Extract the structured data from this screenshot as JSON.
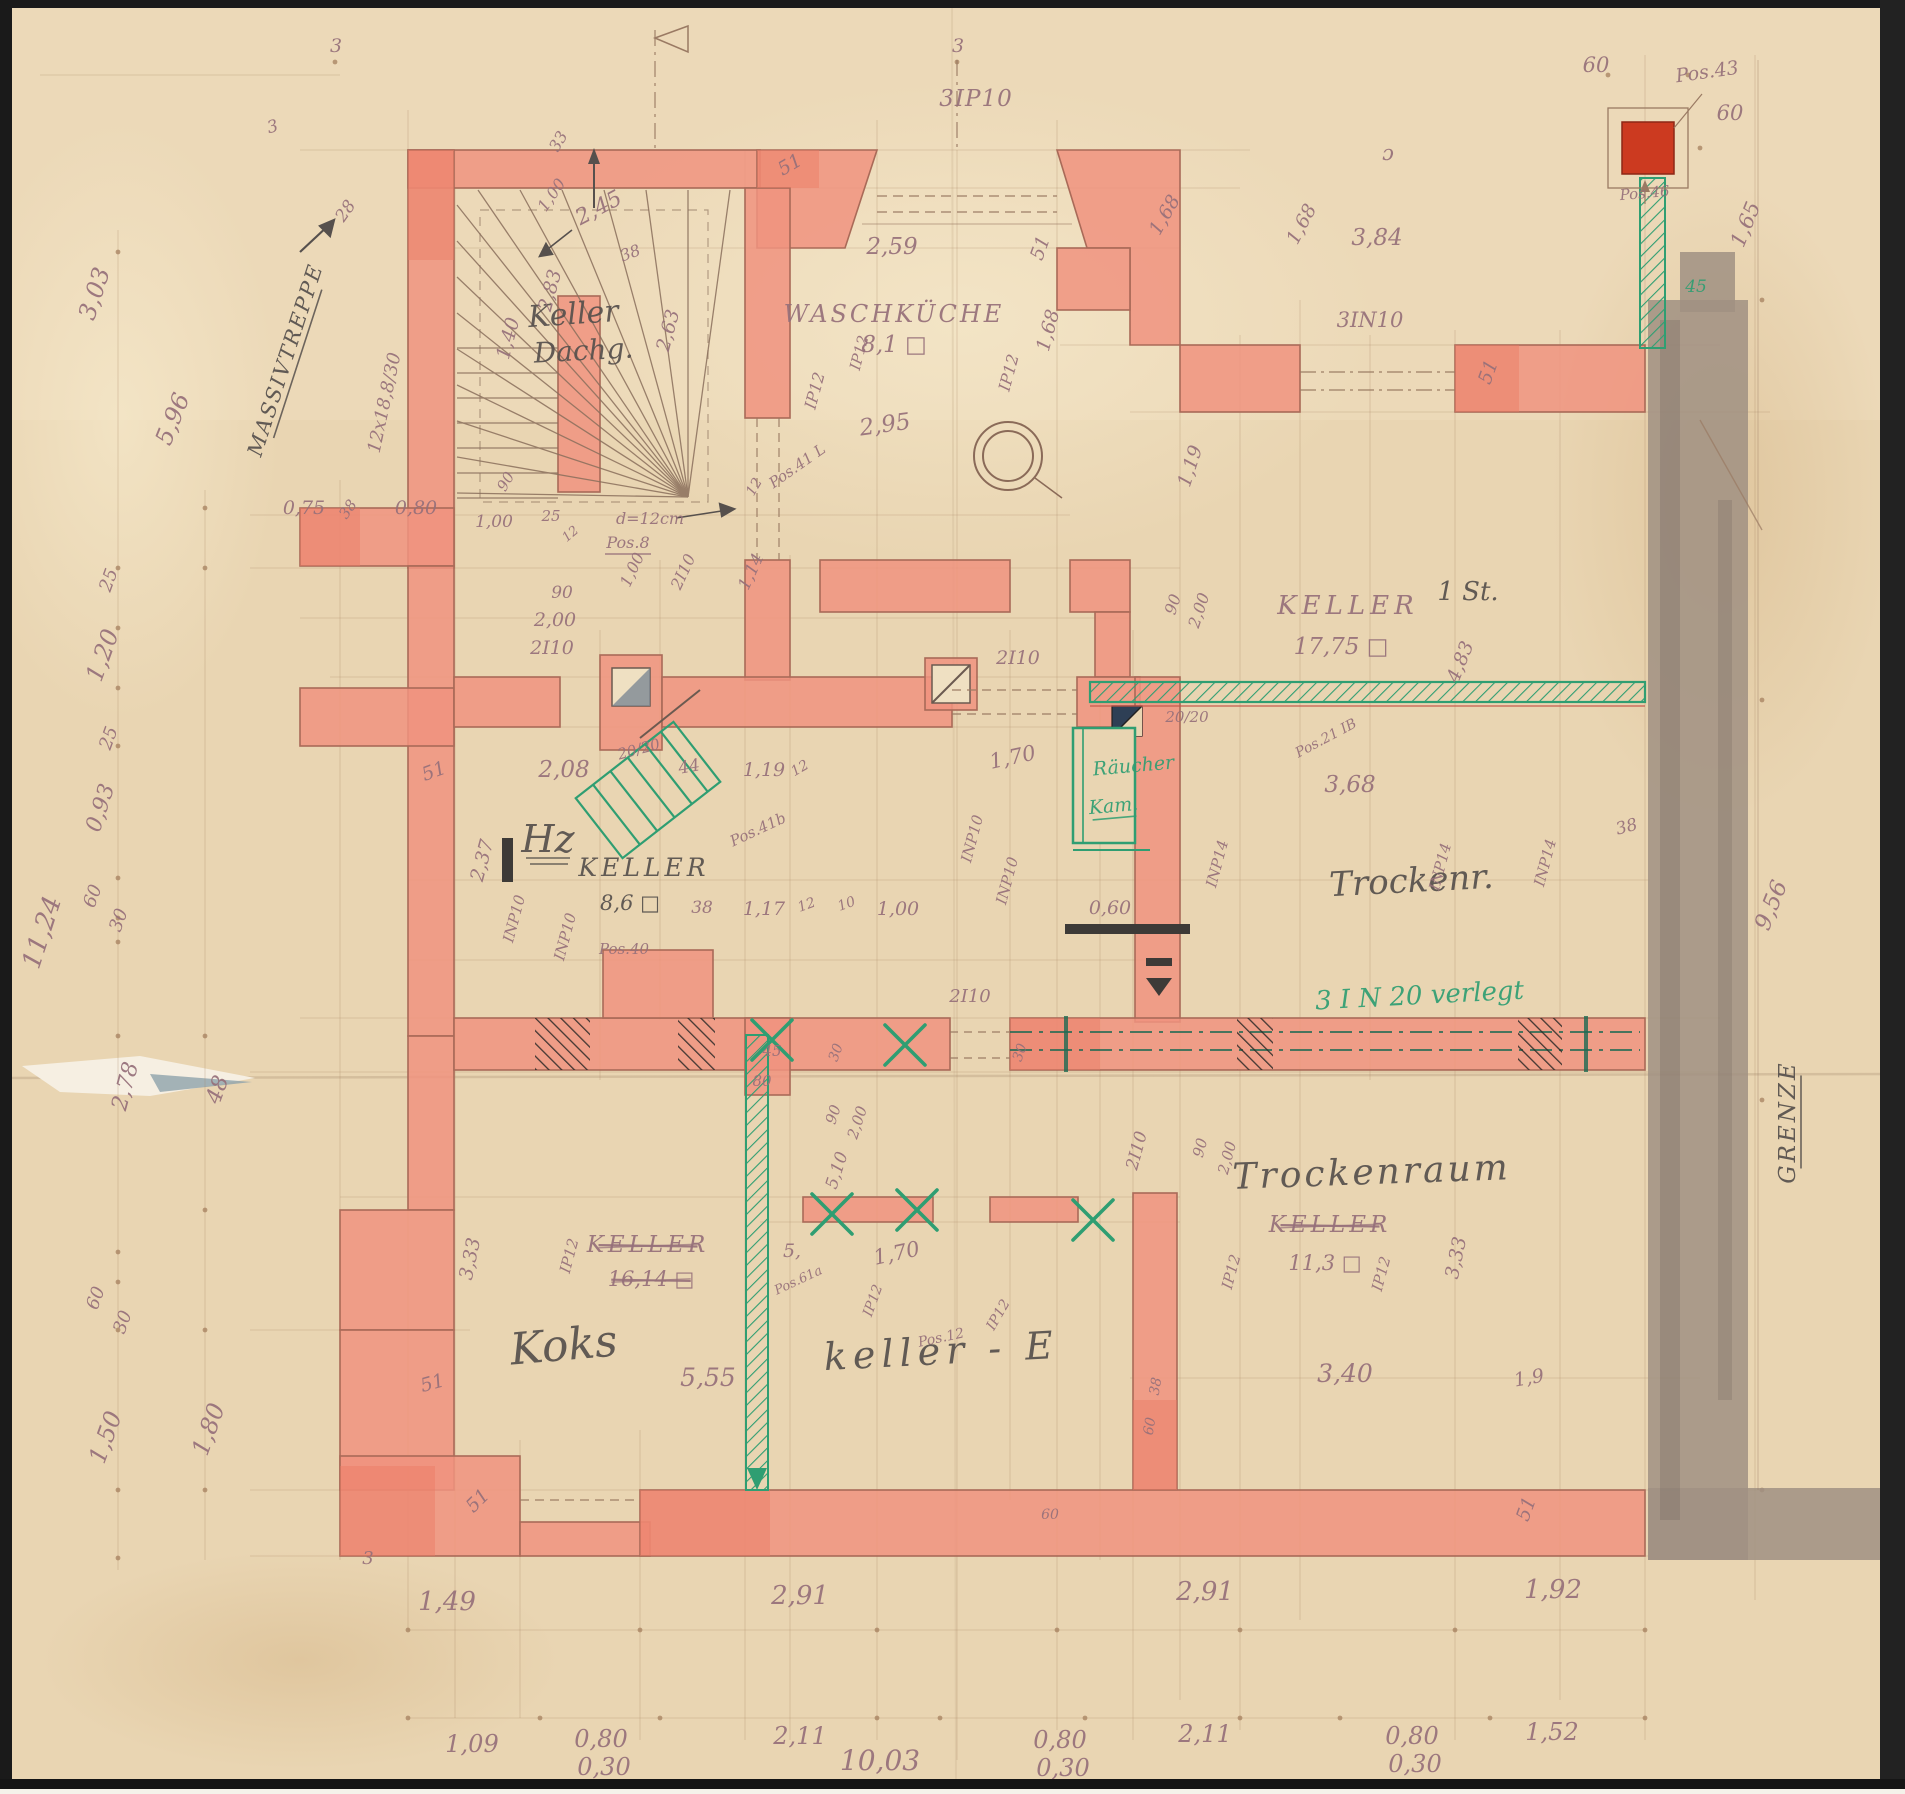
{
  "drawing": {
    "kind": "hand-drawn basement floor plan (scanned blueprint)",
    "language": "German",
    "boundary_label": "GRENZE",
    "stair_label": "MASSIVTREPPE",
    "stair_note": "12x18,8/30",
    "total_width_label": "10,03",
    "left_total_label": "11,24"
  },
  "colors": {
    "paper": "#e9d5b2",
    "paperLight": "#f2e4c6",
    "wall": "#f0937f",
    "wallDark": "#e9english7a64",
    "wallAccent": "#ea7a64",
    "wallLine": "#a96a58",
    "pencil": "#a5805f",
    "dim": "#96707a",
    "ink": "#56504d",
    "green": "#2f9e72",
    "graywall": "#a09183",
    "redsquare": "#cc3a20",
    "border": "#1a1a1a"
  },
  "rooms": [
    {
      "label": "Keller Dachg."
    },
    {
      "label": "Waschküche",
      "area": "8,1"
    },
    {
      "label": "Keller",
      "area": "17,75",
      "note": "1 St."
    },
    {
      "label": "Hz Keller",
      "area": "8,6"
    },
    {
      "label": "Trockenr."
    },
    {
      "label": "Räucher Kam.",
      "color": "green"
    },
    {
      "label": "Koks"
    },
    {
      "label": "Keller",
      "area": "16,14",
      "struck": true
    },
    {
      "label": "keller - E"
    },
    {
      "label": "Trockenraum",
      "former_label": "Keller",
      "former_struck": true,
      "area": "11,3"
    }
  ],
  "green_annotations": [
    "3 I N 20 verlegt",
    "Räucher Kam.",
    "45"
  ],
  "labels": [
    {
      "t": "3",
      "x": 336,
      "y": 52,
      "s": 19
    },
    {
      "t": "3",
      "x": 274,
      "y": 132,
      "s": 17,
      "r": -15
    },
    {
      "t": "MASSIVTREPPE",
      "x": 292,
      "y": 362,
      "r": -72,
      "s": 21,
      "c": "ink",
      "u": 1,
      "ls": 2
    },
    {
      "t": "28",
      "x": 350,
      "y": 214,
      "r": -55,
      "s": 17
    },
    {
      "t": "12x18,8/30",
      "x": 390,
      "y": 404,
      "r": -78,
      "s": 18
    },
    {
      "t": "2,45",
      "x": 602,
      "y": 214,
      "r": -28,
      "s": 22
    },
    {
      "t": "1,00",
      "x": 556,
      "y": 198,
      "r": -55,
      "s": 16
    },
    {
      "t": "33",
      "x": 563,
      "y": 144,
      "r": -60,
      "s": 16
    },
    {
      "t": "Keller",
      "x": 574,
      "y": 324,
      "s": 30,
      "c": "ink",
      "r": -4
    },
    {
      "t": "Dachg.",
      "x": 584,
      "y": 360,
      "s": 28,
      "c": "ink",
      "r": -3
    },
    {
      "t": "2,83",
      "x": 556,
      "y": 292,
      "r": -75,
      "s": 19
    },
    {
      "t": "1,40",
      "x": 514,
      "y": 340,
      "r": -75,
      "s": 19
    },
    {
      "t": "90",
      "x": 510,
      "y": 484,
      "r": -60,
      "s": 15
    },
    {
      "t": "38",
      "x": 632,
      "y": 258,
      "r": -20,
      "s": 16
    },
    {
      "t": "3",
      "x": 958,
      "y": 52,
      "s": 19
    },
    {
      "t": "3IP10",
      "x": 976,
      "y": 106,
      "s": 23,
      "ls": 1
    },
    {
      "t": "51",
      "x": 793,
      "y": 170,
      "r": -30,
      "s": 19
    },
    {
      "t": "2,59",
      "x": 892,
      "y": 254,
      "s": 23
    },
    {
      "t": "WASCHKÜCHE",
      "x": 894,
      "y": 322,
      "s": 24,
      "ls": 3
    },
    {
      "t": "8,1 □",
      "x": 894,
      "y": 352,
      "s": 23
    },
    {
      "t": "2,95",
      "x": 886,
      "y": 432,
      "r": -8,
      "s": 23
    },
    {
      "t": "Pos.41 L",
      "x": 800,
      "y": 470,
      "r": -35,
      "s": 15
    },
    {
      "t": "IP12",
      "x": 820,
      "y": 392,
      "r": -75,
      "s": 16
    },
    {
      "t": "IP12",
      "x": 864,
      "y": 354,
      "r": -75,
      "s": 15
    },
    {
      "t": "2,63",
      "x": 674,
      "y": 332,
      "r": -75,
      "s": 19
    },
    {
      "t": "1,68",
      "x": 1054,
      "y": 332,
      "r": -75,
      "s": 19
    },
    {
      "t": "IP12",
      "x": 1014,
      "y": 374,
      "r": -75,
      "s": 16
    },
    {
      "t": "1,68",
      "x": 1170,
      "y": 218,
      "r": -60,
      "s": 19
    },
    {
      "t": "51",
      "x": 1046,
      "y": 250,
      "r": -70,
      "s": 19
    },
    {
      "t": "1,00",
      "x": 494,
      "y": 527,
      "s": 17
    },
    {
      "t": "25",
      "x": 551,
      "y": 521,
      "s": 15
    },
    {
      "t": "12",
      "x": 573,
      "y": 537,
      "r": -40,
      "s": 13
    },
    {
      "t": "d=12cm",
      "x": 650,
      "y": 524,
      "s": 16
    },
    {
      "t": "Pos.8",
      "x": 628,
      "y": 548,
      "s": 16,
      "u": 1
    },
    {
      "t": "1,00",
      "x": 637,
      "y": 572,
      "r": -65,
      "s": 16
    },
    {
      "t": "2I10",
      "x": 688,
      "y": 574,
      "r": -65,
      "s": 16
    },
    {
      "t": "1,14",
      "x": 756,
      "y": 574,
      "r": -65,
      "s": 17
    },
    {
      "t": "12",
      "x": 758,
      "y": 489,
      "r": -60,
      "s": 14
    },
    {
      "t": "90",
      "x": 562,
      "y": 598,
      "s": 17
    },
    {
      "t": "2,00",
      "x": 555,
      "y": 626,
      "s": 19
    },
    {
      "t": "2I10",
      "x": 552,
      "y": 654,
      "s": 19
    },
    {
      "t": "0,75",
      "x": 304,
      "y": 514,
      "s": 19
    },
    {
      "t": "38",
      "x": 352,
      "y": 512,
      "r": -55,
      "s": 15
    },
    {
      "t": "0,80",
      "x": 416,
      "y": 514,
      "s": 19
    },
    {
      "t": "2I10",
      "x": 1018,
      "y": 664,
      "s": 19
    },
    {
      "t": "2,08",
      "x": 564,
      "y": 777,
      "s": 23
    },
    {
      "t": "20/20",
      "x": 640,
      "y": 754,
      "r": -15,
      "s": 15
    },
    {
      "t": "44",
      "x": 690,
      "y": 772,
      "r": -10,
      "s": 17
    },
    {
      "t": "1,19",
      "x": 764,
      "y": 776,
      "s": 19
    },
    {
      "t": "12",
      "x": 802,
      "y": 772,
      "r": -30,
      "s": 14
    },
    {
      "t": "1,70",
      "x": 1014,
      "y": 764,
      "r": -12,
      "s": 21
    },
    {
      "t": "Hz",
      "x": 548,
      "y": 852,
      "s": 38,
      "c": "ink",
      "u": 2
    },
    {
      "t": "KELLER",
      "x": 644,
      "y": 876,
      "s": 25,
      "c": "ink",
      "ls": 4
    },
    {
      "t": "8,6 □",
      "x": 630,
      "y": 910,
      "s": 21,
      "c": "ink"
    },
    {
      "t": "38",
      "x": 702,
      "y": 913,
      "s": 17
    },
    {
      "t": "1,17",
      "x": 764,
      "y": 915,
      "s": 19
    },
    {
      "t": "12",
      "x": 808,
      "y": 909,
      "r": -20,
      "s": 14
    },
    {
      "t": "10",
      "x": 848,
      "y": 908,
      "r": -20,
      "s": 14
    },
    {
      "t": "1,00",
      "x": 898,
      "y": 915,
      "s": 19
    },
    {
      "t": "0,60",
      "x": 1110,
      "y": 914,
      "s": 19
    },
    {
      "t": "2,37",
      "x": 488,
      "y": 862,
      "r": -75,
      "s": 19
    },
    {
      "t": "INP10",
      "x": 519,
      "y": 920,
      "r": -75,
      "s": 15
    },
    {
      "t": "INP10",
      "x": 570,
      "y": 938,
      "r": -75,
      "s": 15
    },
    {
      "t": "Pos.41b",
      "x": 760,
      "y": 834,
      "r": -25,
      "s": 15
    },
    {
      "t": "INP10",
      "x": 977,
      "y": 840,
      "r": -75,
      "s": 15
    },
    {
      "t": "INP10",
      "x": 1012,
      "y": 882,
      "r": -75,
      "s": 15
    },
    {
      "t": "51",
      "x": 436,
      "y": 777,
      "r": -20,
      "s": 19
    },
    {
      "t": "Pos.40",
      "x": 624,
      "y": 954,
      "s": 15
    },
    {
      "t": "45",
      "x": 772,
      "y": 1056,
      "s": 15
    },
    {
      "t": "30",
      "x": 840,
      "y": 1054,
      "r": -70,
      "s": 14
    },
    {
      "t": "80",
      "x": 762,
      "y": 1086,
      "s": 15
    },
    {
      "t": "2I10",
      "x": 970,
      "y": 1002,
      "s": 18
    },
    {
      "t": "30",
      "x": 1024,
      "y": 1054,
      "r": -70,
      "s": 14
    },
    {
      "t": "Räucher",
      "x": 1134,
      "y": 772,
      "s": 19,
      "c": "green",
      "r": -5
    },
    {
      "t": "Kam.",
      "x": 1114,
      "y": 812,
      "s": 19,
      "c": "green",
      "u": 1,
      "r": -5
    },
    {
      "t": "20/20",
      "x": 1187,
      "y": 722,
      "s": 15
    },
    {
      "t": "KELLER",
      "x": 1348,
      "y": 614,
      "s": 26,
      "ls": 5
    },
    {
      "t": "1 St.",
      "x": 1468,
      "y": 600,
      "s": 26,
      "c": "ink"
    },
    {
      "t": "17,75 □",
      "x": 1341,
      "y": 654,
      "s": 23
    },
    {
      "t": "90",
      "x": 1178,
      "y": 606,
      "r": -72,
      "s": 16
    },
    {
      "t": "2,00",
      "x": 1204,
      "y": 612,
      "r": -72,
      "s": 16
    },
    {
      "t": "1,19",
      "x": 1196,
      "y": 468,
      "r": -72,
      "s": 19
    },
    {
      "t": "4,83",
      "x": 1466,
      "y": 664,
      "r": -68,
      "s": 19
    },
    {
      "t": "Pos.21 IB",
      "x": 1328,
      "y": 742,
      "r": -28,
      "s": 14
    },
    {
      "t": "3,68",
      "x": 1350,
      "y": 792,
      "s": 23
    },
    {
      "t": "38",
      "x": 1628,
      "y": 832,
      "r": -15,
      "s": 17
    },
    {
      "t": "Trockenr.",
      "x": 1412,
      "y": 892,
      "s": 34,
      "c": "ink",
      "r": -3
    },
    {
      "t": "INP14",
      "x": 1222,
      "y": 865,
      "r": -75,
      "s": 15
    },
    {
      "t": "INP14",
      "x": 1445,
      "y": 868,
      "r": -75,
      "s": 15
    },
    {
      "t": "INP14",
      "x": 1550,
      "y": 864,
      "r": -75,
      "s": 15
    },
    {
      "t": "3 I N 20 verlegt",
      "x": 1420,
      "y": 1004,
      "s": 26,
      "c": "green",
      "r": -3
    },
    {
      "t": "9,56",
      "x": 1778,
      "y": 908,
      "r": -68,
      "s": 23
    },
    {
      "t": "GRENZE",
      "x": 1795,
      "y": 1122,
      "r": -90,
      "s": 23,
      "c": "ink",
      "u": 1,
      "ls": 3
    },
    {
      "t": "1,65",
      "x": 1752,
      "y": 227,
      "r": -68,
      "s": 21
    },
    {
      "t": "60",
      "x": 1596,
      "y": 72,
      "s": 21
    },
    {
      "t": "Pos.43",
      "x": 1708,
      "y": 78,
      "r": -8,
      "s": 19
    },
    {
      "t": "60",
      "x": 1730,
      "y": 120,
      "s": 21
    },
    {
      "t": "Pos.46",
      "x": 1645,
      "y": 198,
      "r": -5,
      "s": 15
    },
    {
      "t": "45",
      "x": 1696,
      "y": 292,
      "s": 17,
      "c": "green"
    },
    {
      "t": "3,84",
      "x": 1377,
      "y": 245,
      "s": 23
    },
    {
      "t": "ɔ",
      "x": 1388,
      "y": 160,
      "s": 21
    },
    {
      "t": "1,68",
      "x": 1307,
      "y": 227,
      "r": -62,
      "s": 19
    },
    {
      "t": "3IN10",
      "x": 1370,
      "y": 327,
      "s": 21
    },
    {
      "t": "51",
      "x": 1494,
      "y": 374,
      "r": -70,
      "s": 19
    },
    {
      "t": "90",
      "x": 838,
      "y": 1116,
      "r": -72,
      "s": 15
    },
    {
      "t": "2,00",
      "x": 862,
      "y": 1124,
      "r": -72,
      "s": 15
    },
    {
      "t": "5,10",
      "x": 842,
      "y": 1172,
      "r": -72,
      "s": 17
    },
    {
      "t": "2I10",
      "x": 1142,
      "y": 1152,
      "r": -75,
      "s": 17
    },
    {
      "t": "90",
      "x": 1205,
      "y": 1149,
      "r": -75,
      "s": 15
    },
    {
      "t": "2,00",
      "x": 1232,
      "y": 1159,
      "r": -75,
      "s": 15
    },
    {
      "t": "KELLER",
      "x": 648,
      "y": 1252,
      "s": 23,
      "ls": 4,
      "st": 1
    },
    {
      "t": "16,14 □",
      "x": 651,
      "y": 1286,
      "s": 21,
      "st": 1
    },
    {
      "t": "IP12",
      "x": 574,
      "y": 1257,
      "r": -75,
      "s": 15
    },
    {
      "t": "3,33",
      "x": 476,
      "y": 1260,
      "r": -78,
      "s": 19
    },
    {
      "t": "Koks",
      "x": 565,
      "y": 1360,
      "s": 44,
      "c": "ink",
      "r": -5
    },
    {
      "t": "5,55",
      "x": 708,
      "y": 1386,
      "s": 25
    },
    {
      "t": "keller - E",
      "x": 942,
      "y": 1364,
      "s": 38,
      "c": "ink",
      "ls": 6,
      "r": -3
    },
    {
      "t": "1,70",
      "x": 898,
      "y": 1260,
      "r": -12,
      "s": 21
    },
    {
      "t": "5,",
      "x": 792,
      "y": 1257,
      "s": 19
    },
    {
      "t": "Pos.61a",
      "x": 800,
      "y": 1284,
      "r": -25,
      "s": 13
    },
    {
      "t": "IP12",
      "x": 877,
      "y": 1302,
      "r": -70,
      "s": 14
    },
    {
      "t": "IP12",
      "x": 1002,
      "y": 1317,
      "r": -60,
      "s": 14
    },
    {
      "t": "Pos.12",
      "x": 942,
      "y": 1342,
      "r": -12,
      "s": 14
    },
    {
      "t": "Trockenraum",
      "x": 1372,
      "y": 1184,
      "s": 36,
      "c": "ink",
      "ls": 3,
      "r": -2
    },
    {
      "t": "KELLER",
      "x": 1330,
      "y": 1232,
      "s": 23,
      "ls": 4,
      "st": 1
    },
    {
      "t": "11,3 □",
      "x": 1325,
      "y": 1270,
      "s": 21
    },
    {
      "t": "3,40",
      "x": 1345,
      "y": 1382,
      "s": 25
    },
    {
      "t": "1,9",
      "x": 1530,
      "y": 1384,
      "r": -10,
      "s": 19
    },
    {
      "t": "3,33",
      "x": 1462,
      "y": 1259,
      "r": -78,
      "s": 19
    },
    {
      "t": "IP12",
      "x": 1236,
      "y": 1273,
      "r": -75,
      "s": 15
    },
    {
      "t": "IP12",
      "x": 1386,
      "y": 1275,
      "r": -75,
      "s": 15
    },
    {
      "t": "38",
      "x": 1160,
      "y": 1387,
      "r": -80,
      "s": 14
    },
    {
      "t": "60",
      "x": 1154,
      "y": 1427,
      "r": -80,
      "s": 14
    },
    {
      "t": "51",
      "x": 434,
      "y": 1389,
      "r": -15,
      "s": 19
    },
    {
      "t": "51",
      "x": 482,
      "y": 1505,
      "r": -45,
      "s": 19
    },
    {
      "t": "51",
      "x": 1532,
      "y": 1511,
      "r": -70,
      "s": 19
    },
    {
      "t": "60",
      "x": 1050,
      "y": 1519,
      "s": 14
    },
    {
      "t": "3",
      "x": 368,
      "y": 1564,
      "s": 18
    },
    {
      "t": "1,49",
      "x": 447,
      "y": 1610,
      "s": 26
    },
    {
      "t": "2,91",
      "x": 800,
      "y": 1604,
      "s": 26
    },
    {
      "t": "2,91",
      "x": 1205,
      "y": 1600,
      "s": 26
    },
    {
      "t": "1,92",
      "x": 1553,
      "y": 1598,
      "s": 26
    },
    {
      "t": "1,09",
      "x": 472,
      "y": 1752,
      "s": 24
    },
    {
      "t": "0,80",
      "x": 601,
      "y": 1747,
      "s": 24
    },
    {
      "t": "0,30",
      "x": 604,
      "y": 1775,
      "s": 24
    },
    {
      "t": "2,11",
      "x": 800,
      "y": 1744,
      "s": 24
    },
    {
      "t": "0,80",
      "x": 1060,
      "y": 1748,
      "s": 24
    },
    {
      "t": "0,30",
      "x": 1063,
      "y": 1776,
      "s": 24
    },
    {
      "t": "2,11",
      "x": 1205,
      "y": 1742,
      "s": 24
    },
    {
      "t": "0,80",
      "x": 1412,
      "y": 1744,
      "s": 24
    },
    {
      "t": "0,30",
      "x": 1415,
      "y": 1772,
      "s": 24
    },
    {
      "t": "1,52",
      "x": 1552,
      "y": 1740,
      "s": 24
    },
    {
      "t": "10,03",
      "x": 880,
      "y": 1770,
      "s": 28
    },
    {
      "t": "3,03",
      "x": 102,
      "y": 296,
      "r": -72,
      "s": 24
    },
    {
      "t": "5,96",
      "x": 180,
      "y": 422,
      "r": -68,
      "s": 24
    },
    {
      "t": "25",
      "x": 114,
      "y": 582,
      "r": -70,
      "s": 18
    },
    {
      "t": "1,20",
      "x": 110,
      "y": 658,
      "r": -70,
      "s": 24
    },
    {
      "t": "25",
      "x": 114,
      "y": 740,
      "r": -70,
      "s": 18
    },
    {
      "t": "0,93",
      "x": 107,
      "y": 810,
      "r": -72,
      "s": 22
    },
    {
      "t": "60",
      "x": 98,
      "y": 898,
      "r": -70,
      "s": 18
    },
    {
      "t": "30",
      "x": 124,
      "y": 922,
      "r": -70,
      "s": 18
    },
    {
      "t": "11,24",
      "x": 50,
      "y": 935,
      "r": -72,
      "s": 26
    },
    {
      "t": "2,78",
      "x": 132,
      "y": 1088,
      "r": -75,
      "s": 22
    },
    {
      "t": "48",
      "x": 224,
      "y": 1092,
      "r": -70,
      "s": 22
    },
    {
      "t": "60",
      "x": 101,
      "y": 1300,
      "r": -70,
      "s": 18
    },
    {
      "t": "30",
      "x": 128,
      "y": 1324,
      "r": -70,
      "s": 18
    },
    {
      "t": "1,50",
      "x": 113,
      "y": 1440,
      "r": -70,
      "s": 24
    },
    {
      "t": "1,80",
      "x": 216,
      "y": 1432,
      "r": -70,
      "s": 24
    }
  ]
}
